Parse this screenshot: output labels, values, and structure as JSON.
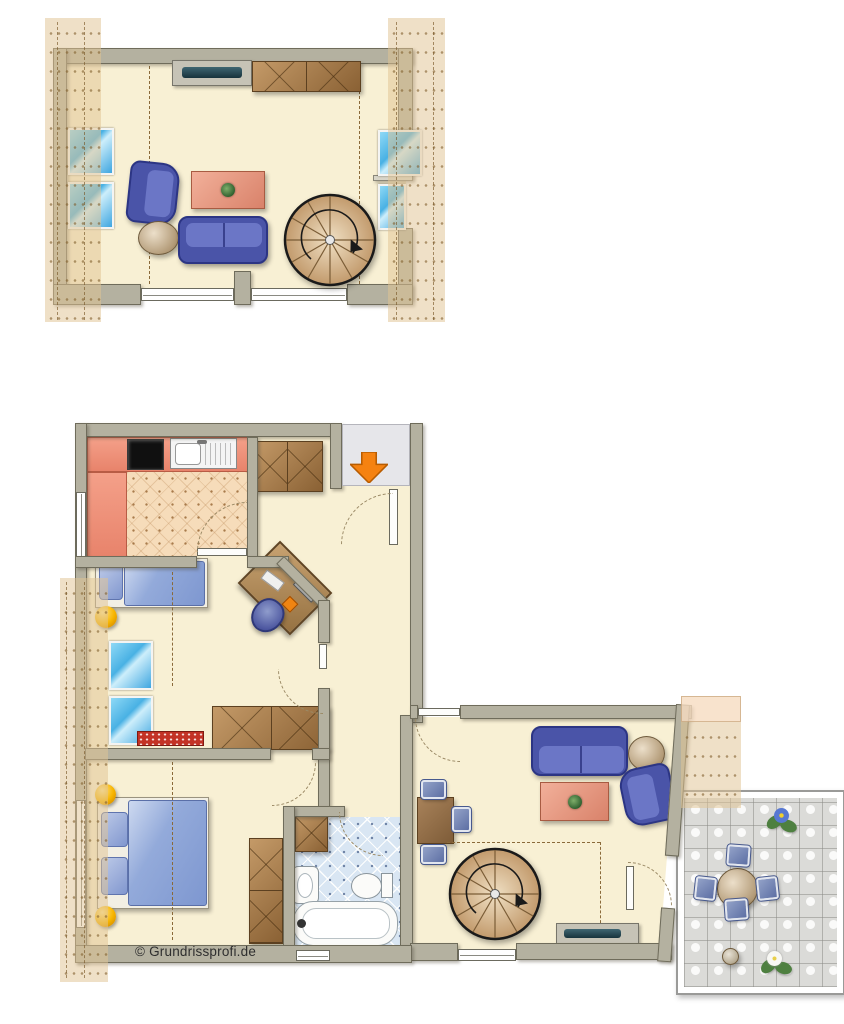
{
  "watermark": {
    "text": "© Grundrissprofi.de"
  },
  "palette": {
    "floor": "#f8f0d4",
    "wall": "#b4b1a0",
    "wall_edge": "#6f6c5b",
    "roof_hatch": "#e1c594",
    "kitchen_counter": "#ef9077",
    "kitchen_tile": "#f6dcba",
    "bath_tile": "#d9e6f3",
    "window_blue": "#56b9e8",
    "furniture_blue": "#4a54a8",
    "wood": "#a8835a",
    "table_coral": "#e89a84",
    "entry_arrow_orange": "#f58211",
    "lamp_yellow": "#f7b500",
    "radiator_red": "#c33326",
    "terrace_tile": "#dbdbd8",
    "entry_floor": "#e6e6ea"
  },
  "floors": [
    {
      "name": "attic-studio",
      "furniture": [
        "tv-sideboard",
        "wooden-chest",
        "armchair",
        "round-side-table",
        "sofa",
        "coffee-table-with-plant",
        "spiral-staircase"
      ],
      "features": [
        "roof-hatch-left",
        "roof-hatch-right",
        "knee-wall-dashed-lines",
        "skylights-left:2",
        "skylights-right:2",
        "south-window-band",
        "chimney"
      ]
    },
    {
      "name": "main-floor",
      "rooms": [
        {
          "name": "kitchen",
          "furniture": [
            "l-shaped-counter",
            "cooktop",
            "sink"
          ],
          "floor": "tile"
        },
        {
          "name": "hallway",
          "furniture": [
            "wardrobe",
            "wardrobe-low"
          ],
          "features": [
            "entry-arrow",
            "entry-door"
          ]
        },
        {
          "name": "childrens-room",
          "furniture": [
            "single-bed",
            "toy-ball",
            "corner-desk-with-computer",
            "desk-chair",
            "radiator"
          ],
          "skylights": 2
        },
        {
          "name": "bedroom",
          "furniture": [
            "double-bed",
            "bedside-lamp",
            "bedside-lamp",
            "wardrobe"
          ]
        },
        {
          "name": "bathroom",
          "furniture": [
            "cabinet",
            "washbasin",
            "toilet",
            "bathtub"
          ],
          "floor": "tile"
        },
        {
          "name": "living-room",
          "furniture": [
            "sofa",
            "round-side-table",
            "armchair",
            "coffee-table-with-plant",
            "dining-table",
            "dining-chairs:3",
            "spiral-staircase",
            "tv-bench"
          ]
        },
        {
          "name": "terrace",
          "furniture": [
            "round-table",
            "terrace-chairs:4",
            "flower-blue",
            "flower-white",
            "plant-pot"
          ]
        }
      ]
    }
  ]
}
